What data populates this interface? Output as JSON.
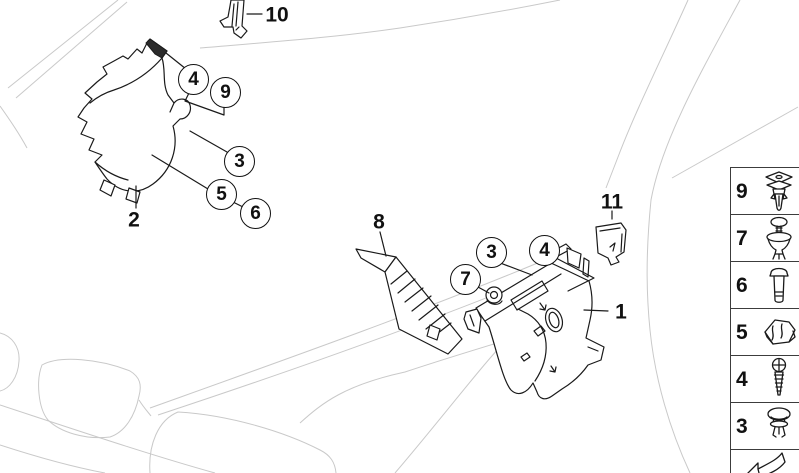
{
  "colors": {
    "background": "#ffffff",
    "line": "#1a1a1a",
    "faint_outline": "#c9c9c9",
    "sidebar_border": "#3c3c3c"
  },
  "callouts": [
    {
      "label": "4",
      "group": "left-trim-panel"
    },
    {
      "label": "9",
      "group": "left-trim-panel"
    },
    {
      "label": "3",
      "group": "left-trim-panel"
    },
    {
      "label": "5",
      "group": "left-trim-panel"
    },
    {
      "label": "6",
      "group": "left-trim-panel"
    },
    {
      "label": "3",
      "group": "right-trim-panel"
    },
    {
      "label": "4",
      "group": "right-trim-panel"
    },
    {
      "label": "7",
      "group": "right-trim-panel"
    }
  ],
  "part_labels": [
    {
      "label": "2"
    },
    {
      "label": "10"
    },
    {
      "label": "8"
    },
    {
      "label": "11"
    },
    {
      "label": "1"
    }
  ],
  "sidebar": {
    "items": [
      {
        "number": "9",
        "icon": "square-head-clip-icon"
      },
      {
        "number": "7",
        "icon": "grommet-screw-icon"
      },
      {
        "number": "6",
        "icon": "hex-bolt-icon"
      },
      {
        "number": "5",
        "icon": "cage-clamp-icon"
      },
      {
        "number": "4",
        "icon": "phillips-screw-icon"
      },
      {
        "number": "3",
        "icon": "push-rivet-icon"
      }
    ],
    "footer_icon": "page-turn-arrow-icon"
  }
}
